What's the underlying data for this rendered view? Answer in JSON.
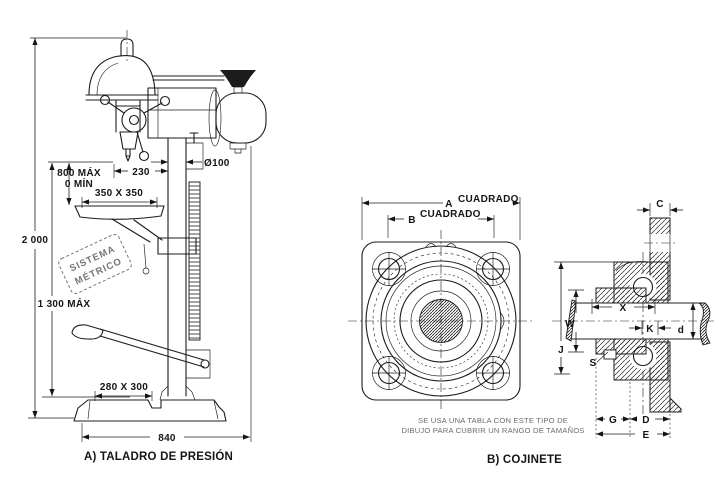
{
  "figure_a": {
    "caption": "A) TALADRO DE PRESIÓN",
    "stamp": {
      "line1": "SISTEMA",
      "line2": "MÉTRICO"
    },
    "dims": {
      "overall_height": "2 000",
      "travel_max": "800 MÁX",
      "travel_min": "0 MÍN",
      "table_size": "350 X 350",
      "spindle_to_column": "230",
      "column_diameter": "Ø100",
      "table_max_height": "1 300 MÁX",
      "base_plate": "280 X 300",
      "base_width": "840"
    }
  },
  "figure_b": {
    "caption": "B) COJINETE",
    "note": {
      "line1": "SE USA UNA TABLA CON ESTE TIPO DE",
      "line2": "DIBUJO PARA CUBRIR UN RANGO DE TAMAÑOS"
    },
    "front_view": {
      "dim_a_letter": "A",
      "dim_a_word": "CUADRADO",
      "dim_b_letter": "B",
      "dim_b_word": "CUADRADO"
    },
    "side_view": {
      "dim_c": "C",
      "dim_w": "W",
      "dim_j": "J",
      "dim_x": "X",
      "dim_k": "K",
      "dim_d_lower": "d",
      "dim_s": "S",
      "dim_g": "G",
      "dim_d_upper": "D",
      "dim_e": "E"
    }
  },
  "colors": {
    "ink": "#1c1c1c",
    "background": "#ffffff",
    "note_text": "#6b6b6b",
    "stamp": "#777777"
  }
}
